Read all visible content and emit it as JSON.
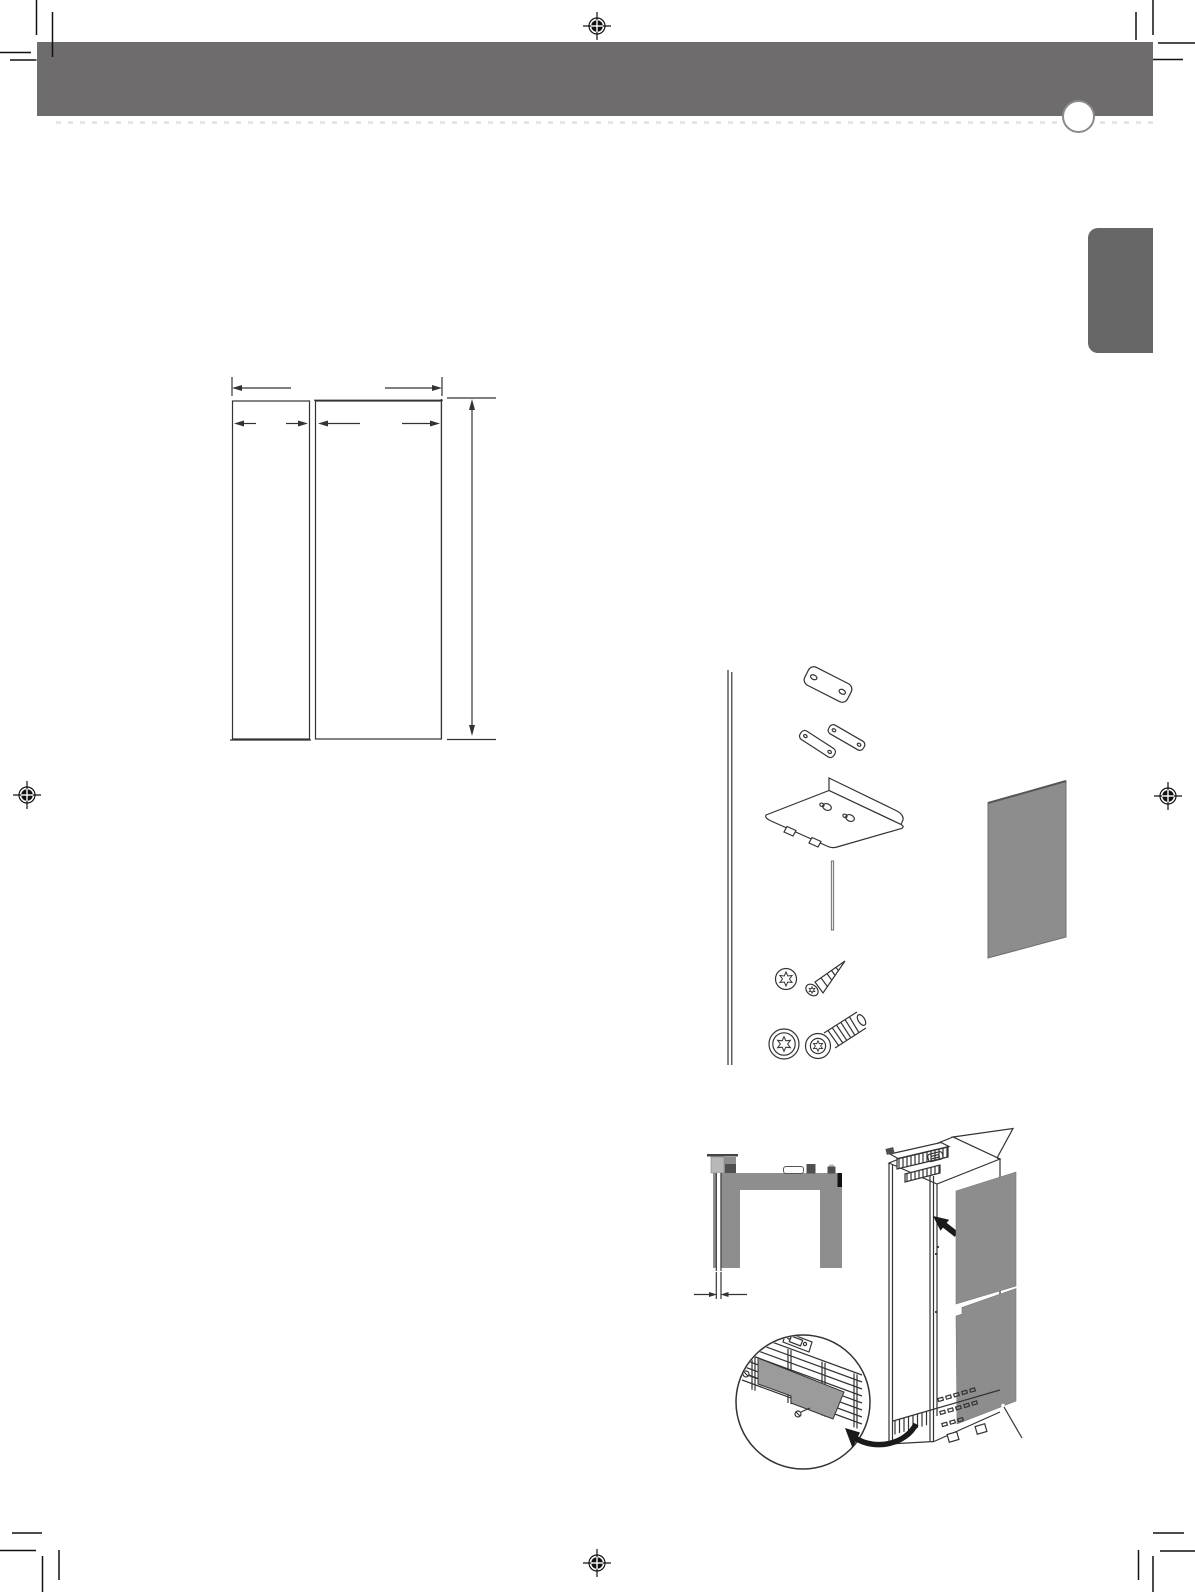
{
  "page": {
    "width": 1195,
    "height": 1592,
    "background": "#ffffff",
    "kind": "installation-manual-page",
    "visible_text": "none"
  },
  "colors": {
    "header_bar": "#6e6c6d",
    "side_tab": "#676767",
    "panel_gray": "#8d8d8d",
    "cover_gray": "#9b9b9b",
    "diagram_gray": "#8e8e8e",
    "dark_part": "#4f4f4f",
    "light_part": "#b8b8b8",
    "line_art": "#333333",
    "arrow_black": "#1a1a1a",
    "dotted_shadow": "#e2e6e5",
    "circle_border": "#8a8a8a"
  },
  "print_marks": {
    "registration_marks": [
      {
        "x": 597,
        "y": 26
      },
      {
        "x": 27,
        "y": 795
      },
      {
        "x": 1168,
        "y": 796
      },
      {
        "x": 597,
        "y": 1563
      }
    ],
    "corner_crop_marks": 4
  },
  "figures": [
    {
      "name": "door-panel-dimension-diagram"
    },
    {
      "name": "mounting-hardware-exploded-view"
    },
    {
      "name": "cabinet-top-view-with-gap-dimension"
    },
    {
      "name": "built-in-fridge-with-base-cover-detail"
    }
  ]
}
